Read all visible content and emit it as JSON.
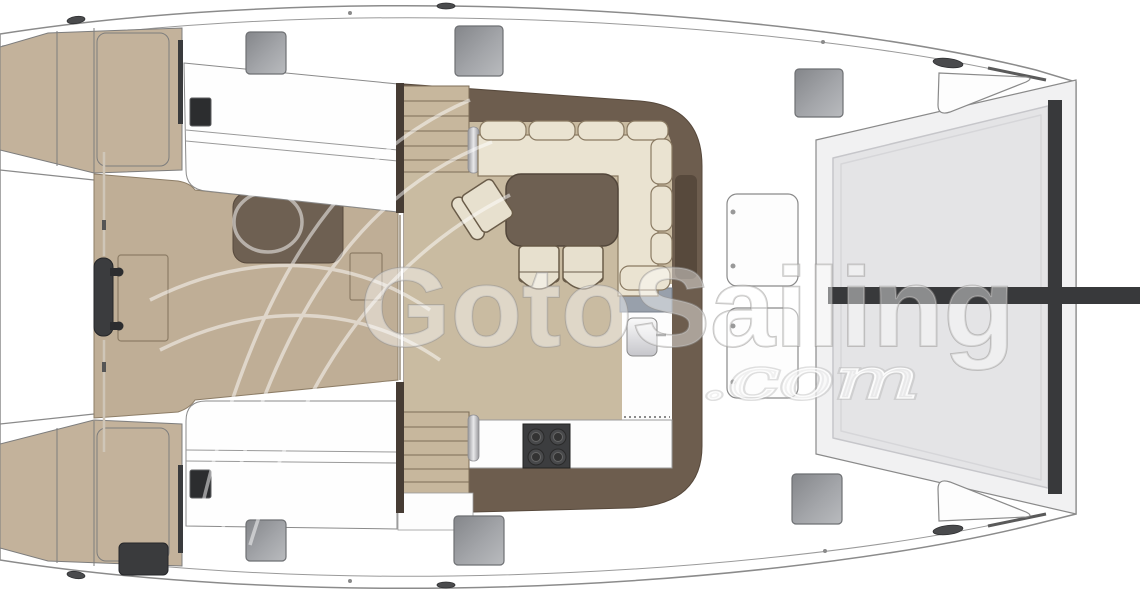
{
  "watermark": {
    "brand": "GotoSailing",
    "suffix": ".com"
  },
  "colors": {
    "hull_white": "#ffffff",
    "outline_gray": "#8b8b8b",
    "deck_tan": "#c3b29b",
    "foredeck_tan": "#bfae96",
    "floor_tan": "#c9bba1",
    "wall_brown": "#6d5d4e",
    "table_brown": "#6e6052",
    "sofa_cream": "#eae3d1",
    "stairs_tan": "#c7b79d",
    "tramp_gray": "#e4e4e6",
    "beam_dark": "#38393b",
    "hatch_dark": "#2c2d2f",
    "hatch_gray": "#9b9da1",
    "sink_gray": "#98a0ab"
  }
}
